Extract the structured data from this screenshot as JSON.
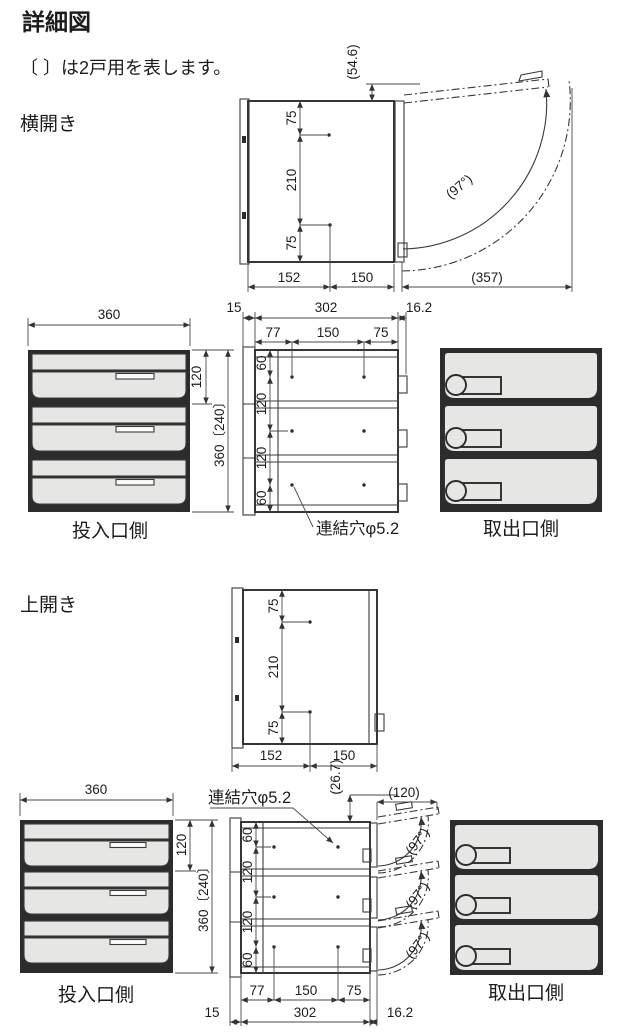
{
  "title": "詳細図",
  "note": "〔 〕は2戸用を表します。",
  "sections": {
    "side_open": "横開き",
    "top_open": "上開き"
  },
  "labels": {
    "input_side": "投入口側",
    "output_side": "取出口側",
    "link_hole": "連結穴φ5.2"
  },
  "dims": {
    "door_offset": "(54.6)",
    "v75": "75",
    "v210": "210",
    "depth_front": "152",
    "depth_rear": "150",
    "door_swing": "(357)",
    "angle": "(97°)",
    "width_front": "360",
    "unit_height": "120",
    "total_height": "360〔240〕",
    "flange": "15",
    "body_width": "302",
    "latch": "16.2",
    "hole_left": "77",
    "hole_mid": "150",
    "hole_right": "75",
    "hole_top": "60",
    "top_offset": "(26.7)",
    "door_proj": "(120)"
  }
}
